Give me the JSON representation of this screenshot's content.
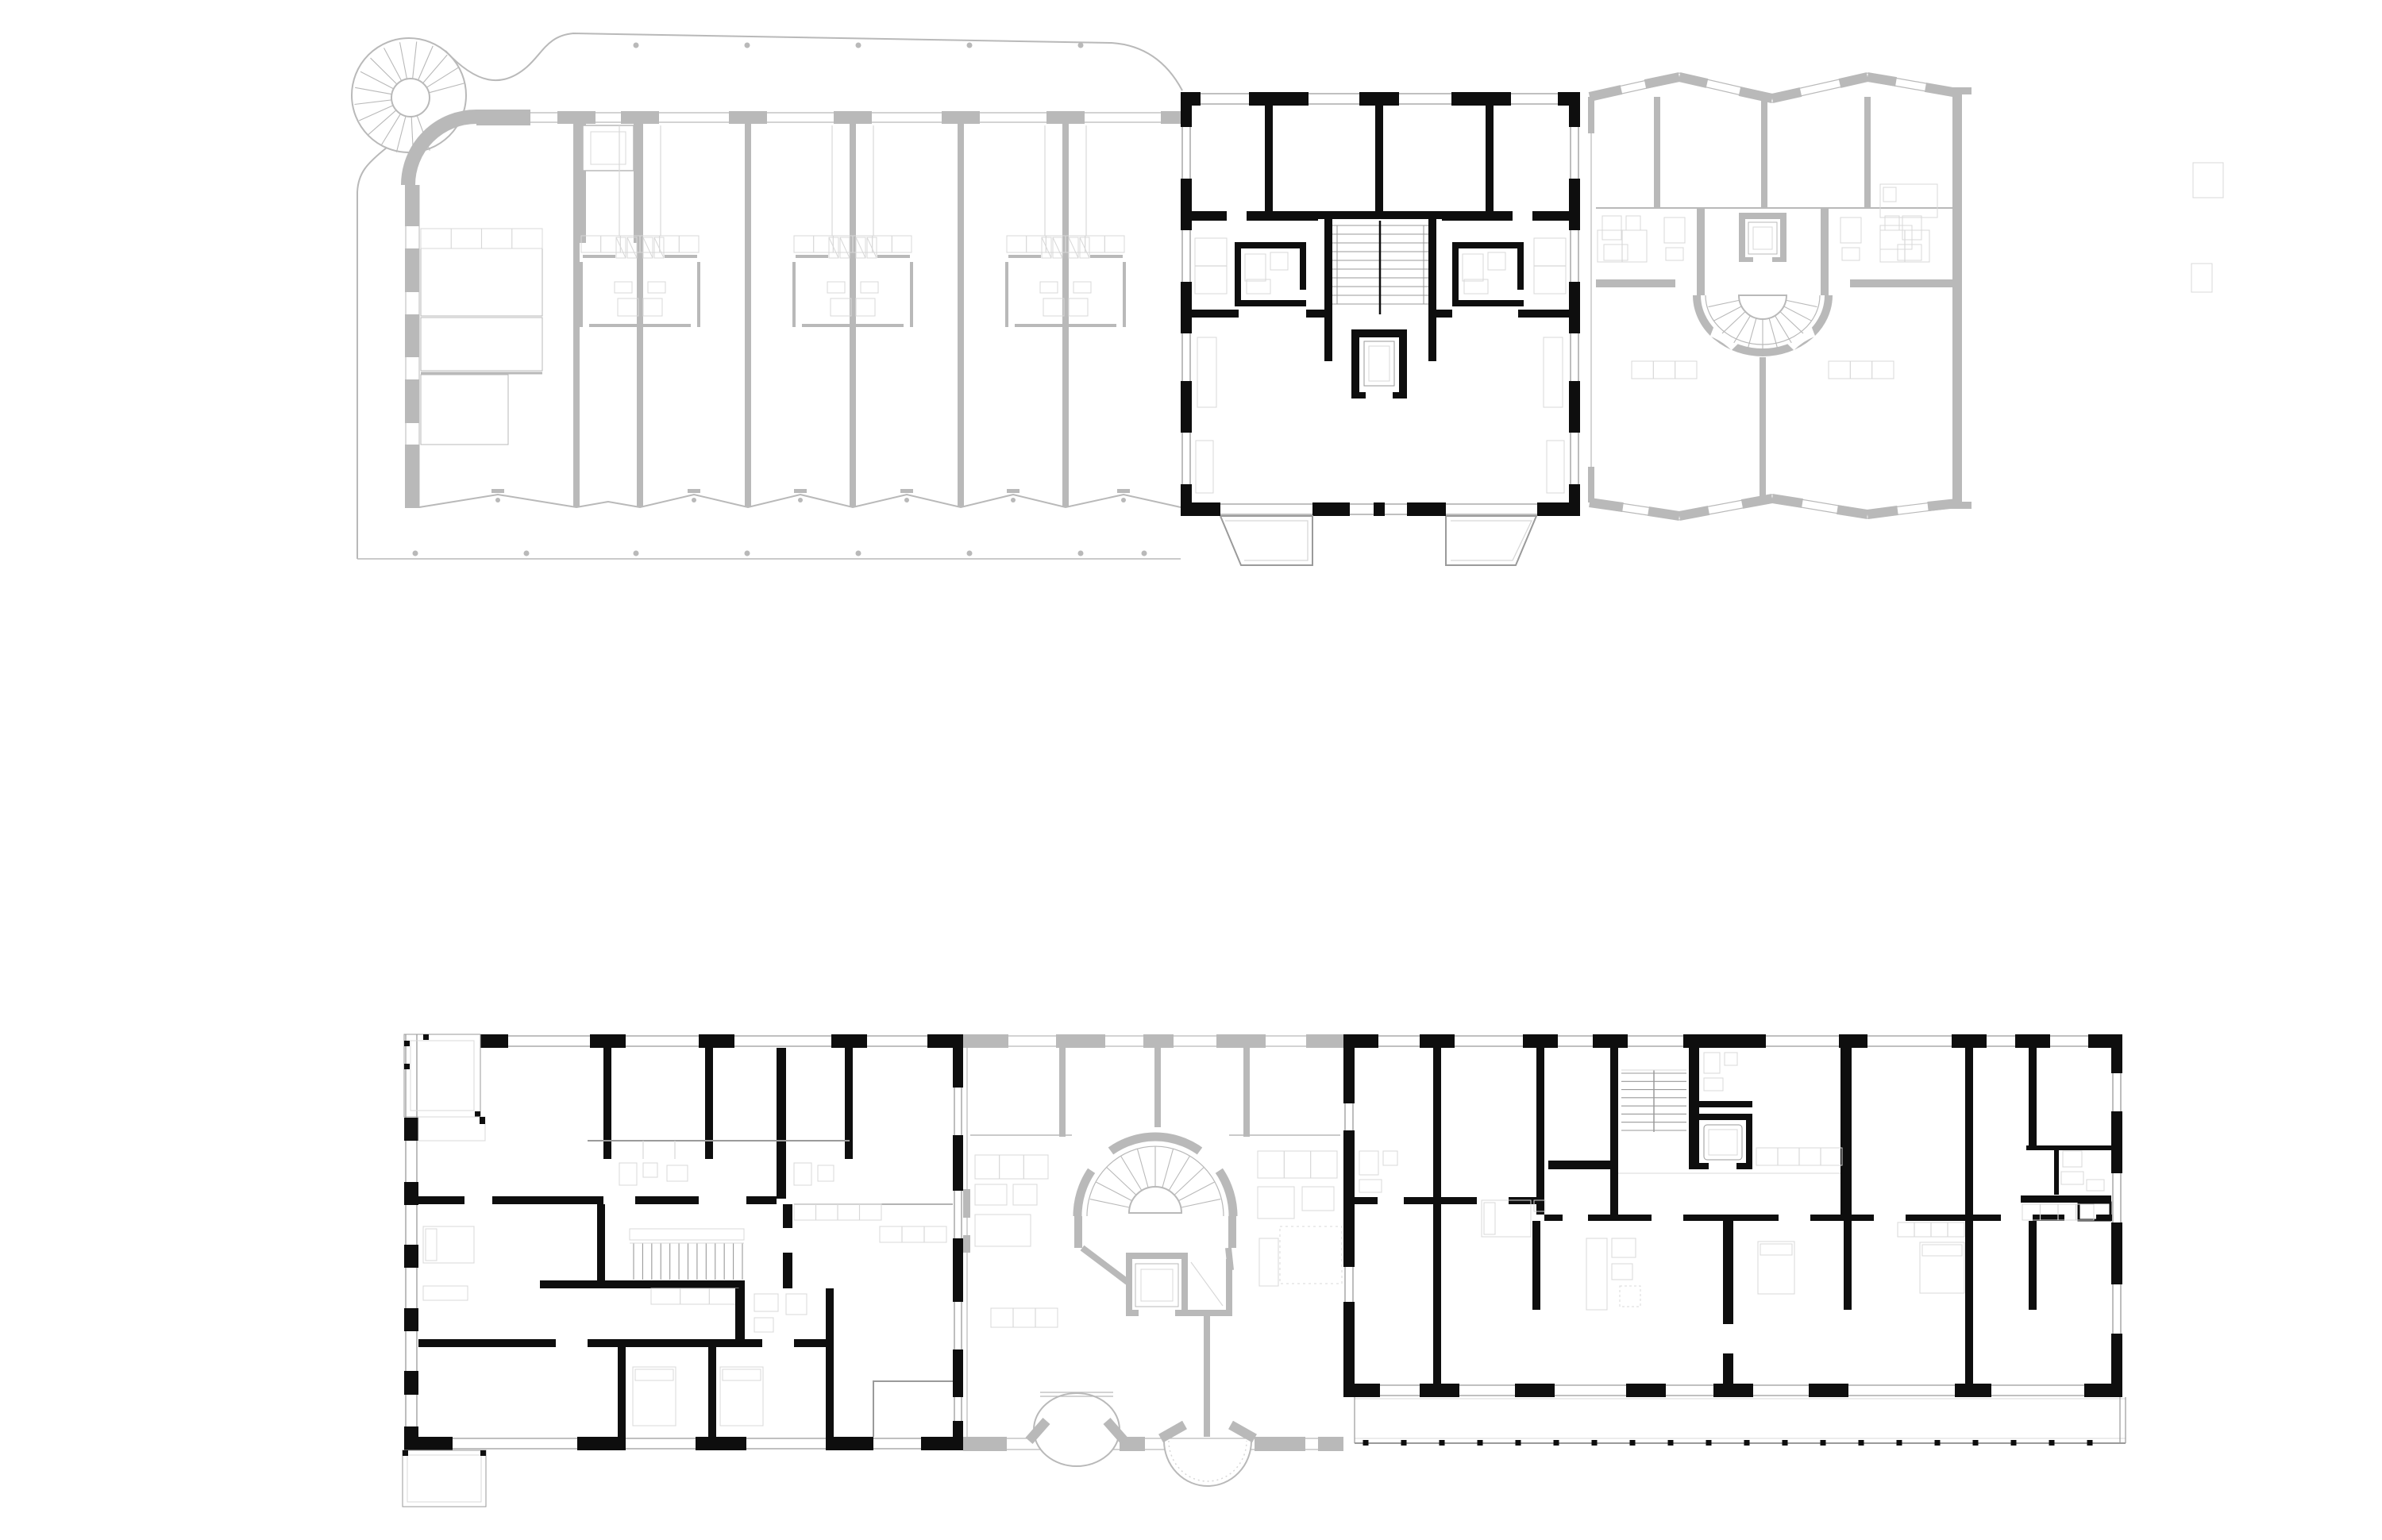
{
  "page": {
    "background": "#ffffff"
  },
  "colors": {
    "highlight_ink": "#0e0e0e",
    "context_wall_gray": "#b9b9b9",
    "furniture_line_gray": "#d8d8d8",
    "window_line_gray": "#9a9a9a",
    "background_white": "#ffffff"
  },
  "drawing": {
    "type": "architectural-floor-plan-set",
    "plan_count": 2,
    "plans": [
      {
        "name": "upper-floor-plan",
        "position": "top",
        "sections": [
          {
            "name": "west-wing",
            "tone": "context",
            "elements": [
              "spiral-stair",
              "wavy-site-outline",
              "bay-walls",
              "service-clusters",
              "shaft",
              "terrace-edge"
            ]
          },
          {
            "name": "highlighted-unit",
            "tone": "highlight",
            "elements": [
              "four-rooms",
              "double-run-stair",
              "elevator",
              "two-bathrooms",
              "two-balconies"
            ]
          },
          {
            "name": "east-wing",
            "tone": "context",
            "elements": [
              "fan-stair",
              "elevator",
              "bathrooms",
              "party-wall"
            ]
          }
        ]
      },
      {
        "name": "lower-floor-plan",
        "position": "bottom",
        "sections": [
          {
            "name": "west-building",
            "tone": "highlight",
            "elements": [
              "corner-loggias",
              "straight-stair",
              "bathrooms",
              "kitchens"
            ]
          },
          {
            "name": "center-section",
            "tone": "context",
            "elements": [
              "fan-stair",
              "elevator",
              "round-balcony",
              "arched-balcony"
            ]
          },
          {
            "name": "east-building",
            "tone": "highlight",
            "elements": [
              "straight-stair",
              "elevator",
              "bathrooms",
              "balcony-strip"
            ]
          }
        ]
      }
    ]
  }
}
